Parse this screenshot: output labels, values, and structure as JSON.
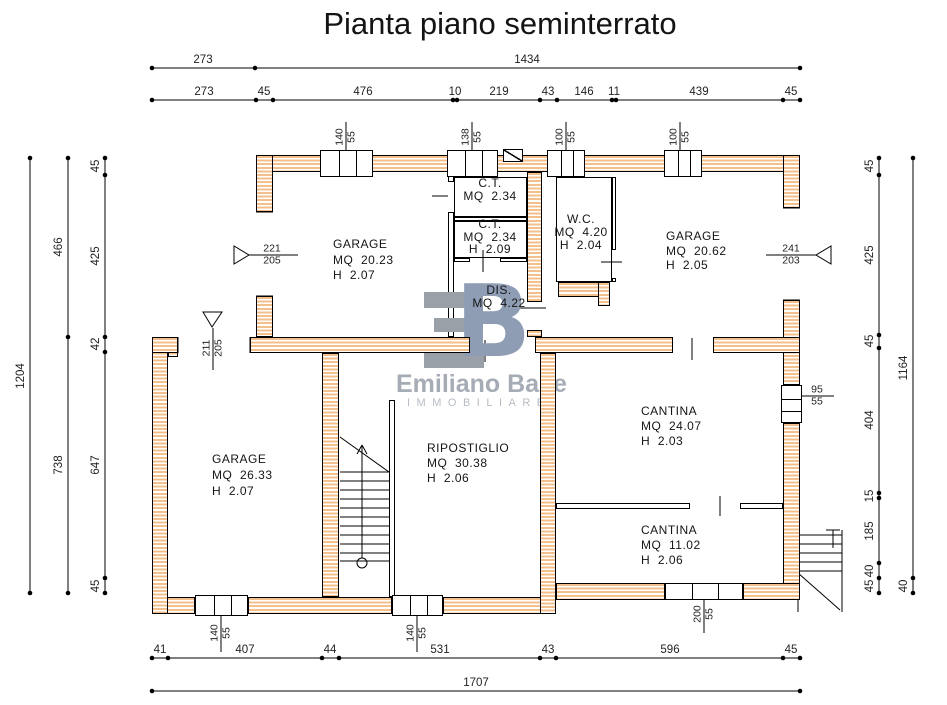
{
  "title": "Pianta piano seminterrato",
  "watermark": {
    "logo_b": "B",
    "name": "Emiliano Base",
    "subtitle": "IMMOBILIARE"
  },
  "colors": {
    "hatch": "#f3bf8b",
    "wall_outline": "#000000",
    "logo_gray": "#9aa0a8",
    "logo_blue": "#8e9cb4",
    "wm_text": "#a6acb5",
    "wm_sub": "#b6bcc4",
    "text": "#151515",
    "dim_text": "#232323"
  },
  "plan": {
    "rooms": [
      {
        "id": "garage-1",
        "x": 333,
        "y": 237,
        "lh": 15.5,
        "align": "left",
        "lines": [
          "GARAGE",
          "MQ  20.23",
          "H  2.07"
        ]
      },
      {
        "id": "ct-1",
        "x": 490,
        "y": 177,
        "lh": 13,
        "align": "center",
        "lines": [
          "C.T.",
          "MQ  2.34"
        ]
      },
      {
        "id": "ct-2",
        "x": 490,
        "y": 218,
        "lh": 12.5,
        "align": "center",
        "lines": [
          "C.T.",
          "MQ  2.34",
          "H  2.09"
        ]
      },
      {
        "id": "wc",
        "x": 581,
        "y": 213,
        "lh": 13,
        "align": "center",
        "lines": [
          "W.C.",
          "MQ  4.20",
          "H  2.04"
        ]
      },
      {
        "id": "garage-2",
        "x": 666,
        "y": 229,
        "lh": 14.5,
        "align": "left",
        "lines": [
          "GARAGE",
          "MQ  20.62",
          "H  2.05"
        ]
      },
      {
        "id": "dis",
        "x": 499,
        "y": 284,
        "lh": 13,
        "align": "center",
        "lines": [
          "DIS.",
          "MQ  4.22"
        ]
      },
      {
        "id": "garage-3",
        "x": 212,
        "y": 451,
        "lh": 16,
        "align": "left",
        "lines": [
          "GARAGE",
          "MQ  26.33",
          "H  2.07"
        ]
      },
      {
        "id": "ripostiglio",
        "x": 427,
        "y": 441,
        "lh": 15,
        "align": "left",
        "lines": [
          "RIPOSTIGLIO",
          "MQ  30.38",
          "H  2.06"
        ]
      },
      {
        "id": "cantina-1",
        "x": 641,
        "y": 404,
        "lh": 15,
        "align": "left",
        "lines": [
          "CANTINA",
          "MQ  24.07",
          "H  2.03"
        ]
      },
      {
        "id": "cantina-2",
        "x": 641,
        "y": 523,
        "lh": 15,
        "align": "left",
        "lines": [
          "CANTINA",
          "MQ  11.02",
          "H  2.06"
        ]
      }
    ],
    "dims_h": [
      {
        "y": 68,
        "x1": 152,
        "x2": 800,
        "ticks": [
          152,
          255,
          800
        ],
        "labels": [
          {
            "x": 203,
            "t": "273"
          },
          {
            "x": 527,
            "t": "1434"
          }
        ]
      },
      {
        "y": 100,
        "x1": 152,
        "x2": 800,
        "ticks": [
          152,
          256,
          273,
          453,
          457,
          540,
          557,
          612,
          616,
          783,
          800
        ],
        "labels": [
          {
            "x": 204,
            "t": "273"
          },
          {
            "x": 264,
            "t": "45"
          },
          {
            "x": 363,
            "t": "476"
          },
          {
            "x": 455,
            "t": "10"
          },
          {
            "x": 499,
            "t": "219"
          },
          {
            "x": 548,
            "t": "43"
          },
          {
            "x": 584,
            "t": "146"
          },
          {
            "x": 614,
            "t": "11"
          },
          {
            "x": 699,
            "t": "439"
          },
          {
            "x": 791,
            "t": "45"
          }
        ]
      },
      {
        "y": 658,
        "x1": 152,
        "x2": 800,
        "ticks": [
          152,
          168,
          322,
          339,
          540,
          556,
          783,
          800
        ],
        "labels": [
          {
            "x": 160,
            "t": "41"
          },
          {
            "x": 245,
            "t": "407"
          },
          {
            "x": 330,
            "t": "44"
          },
          {
            "x": 440,
            "t": "531"
          },
          {
            "x": 548,
            "t": "43"
          },
          {
            "x": 670,
            "t": "596"
          },
          {
            "x": 791,
            "t": "45"
          }
        ]
      },
      {
        "y": 691,
        "x1": 152,
        "x2": 800,
        "ticks": [
          152,
          800
        ],
        "labels": [
          {
            "x": 476,
            "t": "1707"
          }
        ]
      }
    ],
    "dims_v": [
      {
        "x": 105,
        "y1": 158,
        "y2": 593,
        "ticks": [
          158,
          175,
          337,
          352,
          578,
          593
        ],
        "labels": [
          {
            "y": 166,
            "t": "45"
          },
          {
            "y": 256,
            "t": "425"
          },
          {
            "y": 344,
            "t": "42"
          },
          {
            "y": 465,
            "t": "647"
          },
          {
            "y": 586,
            "t": "45"
          }
        ]
      },
      {
        "x": 68,
        "y1": 158,
        "y2": 593,
        "ticks": [
          158,
          337,
          593
        ],
        "labels": [
          {
            "y": 247,
            "t": "466"
          },
          {
            "y": 465,
            "t": "738"
          }
        ]
      },
      {
        "x": 30,
        "y1": 158,
        "y2": 593,
        "ticks": [
          158,
          593
        ],
        "labels": [
          {
            "y": 376,
            "t": "1204"
          }
        ]
      },
      {
        "x": 879,
        "y1": 158,
        "y2": 593,
        "ticks": [
          158,
          175,
          335,
          348,
          493,
          498,
          563,
          578,
          593
        ],
        "labels": [
          {
            "y": 166,
            "t": "45"
          },
          {
            "y": 255,
            "t": "425"
          },
          {
            "y": 341,
            "t": "45"
          },
          {
            "y": 420,
            "t": "404"
          },
          {
            "y": 496,
            "t": "15"
          },
          {
            "y": 531,
            "t": "185"
          },
          {
            "y": 571,
            "t": "40"
          },
          {
            "y": 586,
            "t": "45"
          }
        ]
      },
      {
        "x": 913,
        "y1": 158,
        "y2": 593,
        "ticks": [
          158,
          578,
          593
        ],
        "labels": [
          {
            "y": 368,
            "t": "1164"
          },
          {
            "y": 586,
            "t": "40"
          }
        ]
      }
    ],
    "fracs": [
      {
        "x": 346,
        "y": 137,
        "t1": "140",
        "t2": "55",
        "rot": true
      },
      {
        "x": 472,
        "y": 137,
        "t1": "138",
        "t2": "55",
        "rot": true
      },
      {
        "x": 566,
        "y": 137,
        "t1": "100",
        "t2": "55",
        "rot": true
      },
      {
        "x": 680,
        "y": 137,
        "t1": "100",
        "t2": "55",
        "rot": true
      },
      {
        "x": 221,
        "y": 633,
        "t1": "140",
        "t2": "55",
        "rot": true
      },
      {
        "x": 417,
        "y": 633,
        "t1": "140",
        "t2": "55",
        "rot": true
      },
      {
        "x": 704,
        "y": 614,
        "t1": "200",
        "t2": "55",
        "rot": true
      },
      {
        "x": 213,
        "y": 348,
        "t1": "211",
        "t2": "205",
        "rot": true
      },
      {
        "x": 272,
        "y": 255,
        "t1": "221",
        "t2": "205",
        "rot": false
      },
      {
        "x": 791,
        "y": 255,
        "t1": "241",
        "t2": "203",
        "rot": false
      },
      {
        "x": 817,
        "y": 396,
        "t1": "95",
        "t2": "55",
        "rot": false
      }
    ],
    "walls": [
      {
        "n": "top-wall",
        "x": 256,
        "y": 155,
        "w": 544,
        "h": 17
      },
      {
        "n": "right-wall-upper",
        "x": 783,
        "y": 155,
        "w": 17,
        "h": 53
      },
      {
        "n": "right-wall-mid",
        "x": 783,
        "y": 300,
        "w": 17,
        "h": 85
      },
      {
        "n": "right-wall-lower",
        "x": 783,
        "y": 423,
        "w": 17,
        "h": 177
      },
      {
        "n": "bottom-wall-a",
        "x": 152,
        "y": 597,
        "w": 43,
        "h": 17
      },
      {
        "n": "bottom-wall-b",
        "x": 248,
        "y": 597,
        "w": 144,
        "h": 17
      },
      {
        "n": "bottom-wall-c",
        "x": 443,
        "y": 597,
        "w": 113,
        "h": 17
      },
      {
        "n": "bottom-wall-d",
        "x": 556,
        "y": 583,
        "w": 109,
        "h": 17
      },
      {
        "n": "bottom-wall-e",
        "x": 743,
        "y": 583,
        "w": 57,
        "h": 17
      },
      {
        "n": "left-wall-lower",
        "x": 152,
        "y": 337,
        "w": 16,
        "h": 277
      },
      {
        "n": "left-wall-step",
        "x": 168,
        "y": 337,
        "w": 10,
        "h": 20
      },
      {
        "n": "left-wall-upper-a",
        "x": 256,
        "y": 155,
        "w": 17,
        "h": 57
      },
      {
        "n": "left-wall-upper-b",
        "x": 256,
        "y": 296,
        "w": 17,
        "h": 41
      },
      {
        "n": "mid-wall-a",
        "x": 152,
        "y": 337,
        "w": 26,
        "h": 16
      },
      {
        "n": "mid-wall-b",
        "x": 250,
        "y": 337,
        "w": 220,
        "h": 16
      },
      {
        "n": "mid-wall-c",
        "x": 535,
        "y": 337,
        "w": 138,
        "h": 16
      },
      {
        "n": "mid-wall-d",
        "x": 713,
        "y": 337,
        "w": 87,
        "h": 16
      },
      {
        "n": "ct-wc-wall-a",
        "x": 527,
        "y": 172,
        "w": 15,
        "h": 130
      },
      {
        "n": "ct-wc-wall-b",
        "x": 527,
        "y": 330,
        "w": 15,
        "h": 7
      },
      {
        "n": "rip-cantina-wall",
        "x": 540,
        "y": 353,
        "w": 16,
        "h": 261
      },
      {
        "n": "stair-left-wall",
        "x": 322,
        "y": 353,
        "w": 17,
        "h": 244
      },
      {
        "n": "wc-floor-wall-a",
        "x": 558,
        "y": 282,
        "w": 52,
        "h": 15
      },
      {
        "n": "wc-floor-wall-b",
        "x": 598,
        "y": 282,
        "w": 12,
        "h": 24
      }
    ],
    "thin_walls": [
      {
        "x": 448,
        "y": 172,
        "w": 6,
        "h": 10
      },
      {
        "x": 448,
        "y": 212,
        "w": 6,
        "h": 125
      },
      {
        "x": 389,
        "y": 400,
        "w": 6,
        "h": 197
      },
      {
        "x": 454,
        "y": 217,
        "w": 73,
        "h": 4
      },
      {
        "x": 454,
        "y": 258,
        "w": 16,
        "h": 4
      },
      {
        "x": 500,
        "y": 258,
        "w": 27,
        "h": 4
      },
      {
        "x": 612,
        "y": 177,
        "w": 4,
        "h": 73
      },
      {
        "x": 612,
        "y": 278,
        "w": 4,
        "h": 4
      },
      {
        "x": 556,
        "y": 503,
        "w": 134,
        "h": 6
      },
      {
        "x": 740,
        "y": 503,
        "w": 43,
        "h": 6
      },
      {
        "x": 556,
        "y": 177,
        "w": 56,
        "h": 105,
        "box": true
      },
      {
        "x": 454,
        "y": 177,
        "w": 73,
        "h": 40,
        "box": true
      },
      {
        "x": 454,
        "y": 221,
        "w": 73,
        "h": 37,
        "box": true
      }
    ],
    "windows": [
      {
        "x": 320,
        "y": 150,
        "w": 53,
        "h": 27,
        "o": "v"
      },
      {
        "x": 447,
        "y": 150,
        "w": 51,
        "h": 27,
        "o": "v"
      },
      {
        "x": 547,
        "y": 150,
        "w": 38,
        "h": 27,
        "o": "v"
      },
      {
        "x": 664,
        "y": 150,
        "w": 38,
        "h": 27,
        "o": "v"
      },
      {
        "x": 195,
        "y": 595,
        "w": 53,
        "h": 21,
        "o": "v"
      },
      {
        "x": 392,
        "y": 595,
        "w": 51,
        "h": 21,
        "o": "v"
      },
      {
        "x": 665,
        "y": 583,
        "w": 78,
        "h": 17,
        "o": "v"
      },
      {
        "x": 781,
        "y": 385,
        "w": 21,
        "h": 38,
        "o": "h"
      }
    ],
    "chimney": {
      "x": 503,
      "y": 149,
      "w": 20,
      "h": 13
    },
    "lines": [
      [
        432,
        196,
        448,
        196
      ],
      [
        483,
        250,
        483,
        272
      ],
      [
        601,
        262,
        622,
        262
      ],
      [
        519,
        308,
        546,
        308
      ],
      [
        485,
        340,
        485,
        362
      ],
      [
        692,
        338,
        692,
        360
      ],
      [
        720,
        496,
        720,
        516
      ],
      [
        256,
        212,
        273,
        212
      ],
      [
        256,
        296,
        273,
        296
      ],
      [
        783,
        208,
        800,
        208
      ],
      [
        783,
        300,
        800,
        300
      ],
      [
        178,
        337,
        178,
        353
      ],
      [
        250,
        337,
        250,
        353
      ],
      [
        248,
        255,
        298,
        255
      ],
      [
        766,
        255,
        816,
        255
      ],
      [
        786,
        396,
        834,
        396
      ],
      [
        346,
        122,
        346,
        157
      ],
      [
        472,
        122,
        472,
        157
      ],
      [
        566,
        122,
        566,
        157
      ],
      [
        680,
        122,
        680,
        157
      ],
      [
        221,
        612,
        221,
        652
      ],
      [
        417,
        612,
        417,
        652
      ],
      [
        704,
        600,
        704,
        633
      ],
      [
        213,
        328,
        213,
        370
      ],
      [
        340,
        472,
        389,
        472
      ],
      [
        340,
        481,
        389,
        481
      ],
      [
        340,
        490,
        389,
        490
      ],
      [
        340,
        499,
        389,
        499
      ],
      [
        340,
        508,
        389,
        508
      ],
      [
        340,
        517,
        389,
        517
      ],
      [
        340,
        526,
        389,
        526
      ],
      [
        340,
        535,
        389,
        535
      ],
      [
        340,
        544,
        389,
        544
      ],
      [
        340,
        553,
        389,
        553
      ],
      [
        340,
        561,
        389,
        561
      ],
      [
        340,
        437,
        389,
        472
      ],
      [
        362,
        445,
        362,
        558
      ],
      [
        362,
        445,
        357,
        454
      ],
      [
        362,
        445,
        367,
        454
      ],
      [
        798,
        535,
        842,
        535
      ],
      [
        798,
        544,
        842,
        544
      ],
      [
        798,
        553,
        842,
        553
      ],
      [
        798,
        562,
        842,
        562
      ],
      [
        798,
        571,
        842,
        571
      ],
      [
        842,
        530,
        842,
        612
      ],
      [
        833,
        530,
        833,
        548
      ],
      [
        826,
        530,
        840,
        530
      ],
      [
        798,
        573,
        840,
        610
      ],
      [
        798,
        535,
        798,
        612
      ]
    ],
    "triangles": [
      [
        234,
        246,
        234,
        264,
        249,
        255
      ],
      [
        203,
        312,
        222,
        312,
        212,
        327
      ],
      [
        831,
        246,
        831,
        264,
        816,
        255
      ]
    ],
    "circles": [
      {
        "cx": 362,
        "cy": 563,
        "r": 5
      }
    ]
  }
}
